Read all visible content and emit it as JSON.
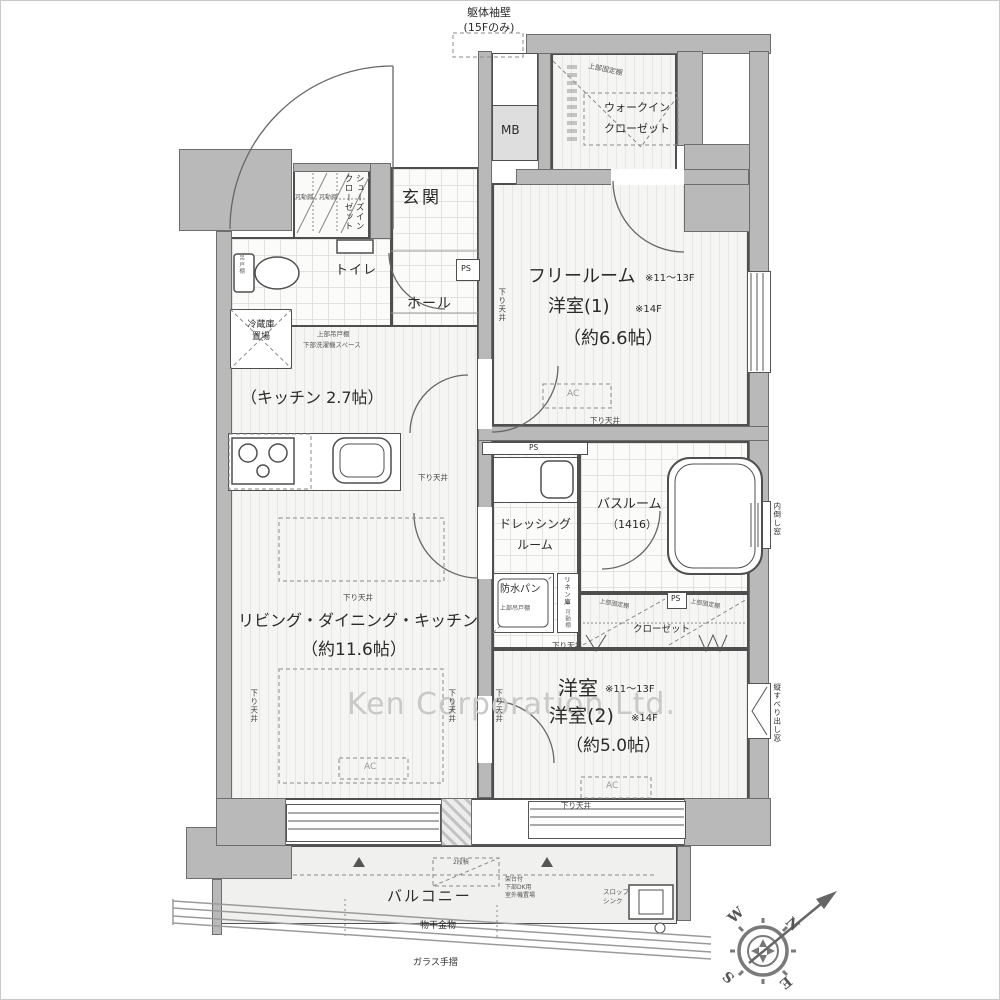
{
  "watermark": "Ken Corporation Ltd.",
  "compass": {
    "n": "N",
    "s": "S",
    "e": "E",
    "w": "W"
  },
  "colors": {
    "wall": "#b9b9b9",
    "line": "#4f4f4f",
    "floor": "#f5f5f3",
    "watermark": "#c9c9c9"
  },
  "rooms_summary": [
    {
      "name": "フリールーム",
      "floors": "※11～13F",
      "alt_name": "洋室(1)",
      "alt_floors": "※14F",
      "area": "約6.6帖"
    },
    {
      "name": "洋室",
      "floors": "※11～13F",
      "alt_name": "洋室(2)",
      "alt_floors": "※14F",
      "area": "約5.0帖"
    },
    {
      "name": "リビング・ダイニング・キッチン",
      "area": "約11.6帖"
    },
    {
      "name": "キッチン",
      "area": "2.7帖"
    }
  ],
  "labels": [
    {
      "id": "watermark-text",
      "text": "Ken Corporation Ltd.",
      "x": 346,
      "y": 684,
      "fs": 30,
      "c": "#c9c9c9",
      "ls": 1
    },
    {
      "id": "note-kutai-sodekabe",
      "text": "躯体袖壁\n(15Fのみ)",
      "x": 448,
      "y": 5,
      "fs": 11,
      "w": 80,
      "ta": "center"
    },
    {
      "id": "label-mb",
      "text": "MB",
      "x": 500,
      "y": 121,
      "fs": 12
    },
    {
      "id": "room-walkin-closet",
      "text": "ウォークイン\nクローゼット",
      "x": 586,
      "y": 97,
      "fs": 11,
      "w": 100,
      "ta": "center",
      "lh": 1.9
    },
    {
      "id": "note-wic-shelf",
      "text": "上部固定棚",
      "x": 588,
      "y": 61,
      "fs": 7,
      "rot": 12,
      "c": "#555"
    },
    {
      "id": "room-genkan",
      "text": "玄関",
      "x": 401,
      "y": 186,
      "fs": 17,
      "ls": 3
    },
    {
      "id": "room-shoes-in-closet",
      "text": "シューズイン\nクローゼット",
      "x": 341,
      "y": 173,
      "fs": 8.5,
      "v": true
    },
    {
      "id": "note-sic-shelf",
      "text": "可動棚　可動棚",
      "x": 294,
      "y": 193,
      "fs": 6,
      "c": "#666"
    },
    {
      "id": "room-toilet",
      "text": "トイレ",
      "x": 334,
      "y": 261,
      "fs": 13,
      "ls": 1
    },
    {
      "id": "note-toilet-shelf",
      "text": "吊戸棚",
      "x": 236,
      "y": 254,
      "fs": 5.5,
      "v": true,
      "c": "#666"
    },
    {
      "id": "room-hall",
      "text": "ホール",
      "x": 406,
      "y": 294,
      "fs": 14,
      "ls": 1
    },
    {
      "id": "label-ps-hall",
      "text": "PS",
      "x": 460,
      "y": 263,
      "fs": 8
    },
    {
      "id": "label-fridge",
      "text": "冷蔵庫\n置場",
      "x": 230,
      "y": 318,
      "fs": 9,
      "w": 60,
      "ta": "center"
    },
    {
      "id": "note-kitchen-upper-cabinet",
      "text": "上部吊戸棚",
      "x": 316,
      "y": 329,
      "fs": 6.5,
      "c": "#555"
    },
    {
      "id": "note-kitchen-washer-space",
      "text": "下部洗濯機スペース",
      "x": 302,
      "y": 340,
      "fs": 6.5,
      "c": "#555"
    },
    {
      "id": "room-kitchen",
      "text": "（キッチン 2.7帖）",
      "x": 240,
      "y": 386,
      "fs": 16
    },
    {
      "id": "room-free-name",
      "text": "フリールーム",
      "x": 527,
      "y": 264,
      "fs": 18
    },
    {
      "id": "room-free-floors",
      "text": "※11～13F",
      "x": 644,
      "y": 271,
      "fs": 10
    },
    {
      "id": "room-free-alt",
      "text": "洋室(1)",
      "x": 547,
      "y": 294,
      "fs": 18
    },
    {
      "id": "room-free-alt-floors",
      "text": "※14F",
      "x": 634,
      "y": 302,
      "fs": 10
    },
    {
      "id": "room-free-area",
      "text": "（約6.6帖）",
      "x": 562,
      "y": 326,
      "fs": 18
    },
    {
      "id": "room-ldk",
      "text": "リビング・ダイニング・キッチン",
      "x": 237,
      "y": 609,
      "fs": 16
    },
    {
      "id": "room-ldk-area",
      "text": "（約11.6帖）",
      "x": 300,
      "y": 638,
      "fs": 17
    },
    {
      "id": "room-dressing",
      "text": "ドレッシング\nルーム",
      "x": 494,
      "y": 513,
      "fs": 12,
      "w": 80,
      "ta": "center",
      "lh": 1.75
    },
    {
      "id": "room-bath",
      "text": "バスルーム",
      "x": 596,
      "y": 495,
      "fs": 13
    },
    {
      "id": "room-bath-size",
      "text": "（1416）",
      "x": 606,
      "y": 517,
      "fs": 11
    },
    {
      "id": "label-bousui-pan",
      "text": "防水パン",
      "x": 499,
      "y": 582,
      "fs": 10
    },
    {
      "id": "note-bousui-cabinet",
      "text": "上部吊戸棚",
      "x": 499,
      "y": 604,
      "fs": 6,
      "c": "#555"
    },
    {
      "id": "label-linen",
      "text": "リネン庫",
      "x": 561,
      "y": 575,
      "fs": 6.5,
      "v": true
    },
    {
      "id": "note-linen-shelf",
      "text": "可動棚",
      "x": 562,
      "y": 608,
      "fs": 5.5,
      "v": true,
      "c": "#666"
    },
    {
      "id": "label-ps-closet",
      "text": "PS",
      "x": 670,
      "y": 593,
      "fs": 7.5
    },
    {
      "id": "label-ps-dressing",
      "text": "PS",
      "x": 528,
      "y": 442,
      "fs": 7.5
    },
    {
      "id": "room-closet",
      "text": "クローゼット",
      "x": 632,
      "y": 623,
      "fs": 9.5
    },
    {
      "id": "note-closet-shelf-left",
      "text": "上部固定棚",
      "x": 599,
      "y": 597,
      "fs": 6,
      "rot": 10,
      "c": "#555"
    },
    {
      "id": "note-closet-shelf-right",
      "text": "上部固定棚",
      "x": 690,
      "y": 597,
      "fs": 6,
      "rot": 10,
      "c": "#555"
    },
    {
      "id": "room-yoshitsu2-name",
      "text": "洋室",
      "x": 557,
      "y": 674,
      "fs": 20
    },
    {
      "id": "room-yoshitsu2-floors",
      "text": "※11～13F",
      "x": 604,
      "y": 682,
      "fs": 10
    },
    {
      "id": "room-yoshitsu2-alt",
      "text": "洋室(2)",
      "x": 548,
      "y": 703,
      "fs": 19
    },
    {
      "id": "room-yoshitsu2-alt-floors",
      "text": "※14F",
      "x": 630,
      "y": 711,
      "fs": 10
    },
    {
      "id": "room-yoshitsu2-area",
      "text": "（約5.0帖）",
      "x": 565,
      "y": 734,
      "fs": 17
    },
    {
      "id": "note-uchitaoshi-window",
      "text": "内倒し窓",
      "x": 771,
      "y": 501,
      "fs": 7.5,
      "v": true
    },
    {
      "id": "note-tatesuberi-window",
      "text": "縦すべり出し窓",
      "x": 771,
      "y": 682,
      "fs": 7.5,
      "v": true
    },
    {
      "id": "room-balcony",
      "text": "バルコニー",
      "x": 386,
      "y": 885,
      "fs": 15,
      "ls": 2
    },
    {
      "id": "note-monohoshi",
      "text": "物干金物",
      "x": 419,
      "y": 919,
      "fs": 9
    },
    {
      "id": "note-glass-rail",
      "text": "ガラス手摺",
      "x": 412,
      "y": 956,
      "fs": 9
    },
    {
      "id": "label-slop-sink",
      "text": "スロップ\nシンク",
      "x": 602,
      "y": 887,
      "fs": 6.5,
      "c": "#555"
    },
    {
      "id": "note-outdoor-unit",
      "text": "架台付\n下部DK用\n室外機置場",
      "x": 504,
      "y": 875,
      "fs": 6,
      "c": "#555"
    },
    {
      "id": "note-nidan",
      "text": "2段積",
      "x": 452,
      "y": 858,
      "fs": 6,
      "c": "#555"
    },
    {
      "id": "ceiling-1",
      "text": "下り天井",
      "x": 496,
      "y": 287,
      "fs": 7.5,
      "v": true,
      "c": "#444"
    },
    {
      "id": "ceiling-2",
      "text": "下り天井",
      "x": 589,
      "y": 415,
      "fs": 7.5,
      "c": "#444"
    },
    {
      "id": "ceiling-3",
      "text": "下り天井",
      "x": 417,
      "y": 472,
      "fs": 7.5,
      "c": "#444"
    },
    {
      "id": "ceiling-4",
      "text": "下り天井",
      "x": 342,
      "y": 592,
      "fs": 7.5,
      "c": "#444"
    },
    {
      "id": "ceiling-5",
      "text": "下り天井",
      "x": 248,
      "y": 688,
      "fs": 7.5,
      "v": true,
      "c": "#444"
    },
    {
      "id": "ceiling-6",
      "text": "下り天井",
      "x": 446,
      "y": 688,
      "fs": 7.5,
      "v": true,
      "c": "#444"
    },
    {
      "id": "ceiling-7",
      "text": "下り天井",
      "x": 493,
      "y": 688,
      "fs": 7.5,
      "v": true,
      "c": "#444"
    },
    {
      "id": "ceiling-8",
      "text": "下り天井",
      "x": 551,
      "y": 640,
      "fs": 7.5,
      "c": "#444"
    },
    {
      "id": "ceiling-9",
      "text": "下り天井",
      "x": 560,
      "y": 800,
      "fs": 7.5,
      "c": "#444"
    },
    {
      "id": "ac-1",
      "text": "AC",
      "x": 566,
      "y": 387,
      "fs": 9,
      "c": "#999"
    },
    {
      "id": "ac-2",
      "text": "AC",
      "x": 363,
      "y": 760,
      "fs": 9,
      "c": "#999"
    },
    {
      "id": "ac-3",
      "text": "AC",
      "x": 605,
      "y": 779,
      "fs": 9,
      "c": "#999"
    }
  ]
}
